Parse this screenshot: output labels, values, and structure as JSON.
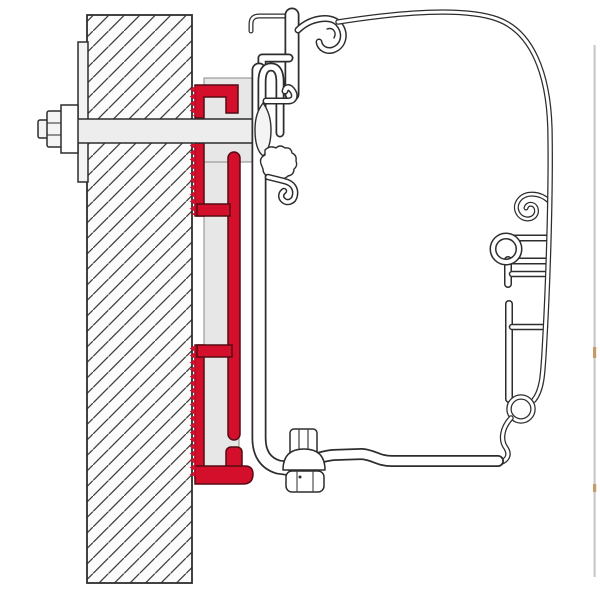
{
  "figure": {
    "kind": "technical-cross-section-line-drawing",
    "parts": {
      "wall": "hatched wall cross-section",
      "mounting_plate": "backing plate on wall face",
      "through_bolt": "through-bolt with hex head and washer",
      "adapter_bracket": "red adapter rail profile with serrated wall edge",
      "rail_profile": "white awning lead rail extrusion",
      "fixing_screw": "screw with dome washer and hex head",
      "case_outline": "awning case outer profile sweep"
    }
  },
  "colors": {
    "background": "#ffffff",
    "wall_fill": "#fcfcfc",
    "hatch": "#3e3e3e",
    "outline": "#2d2d2d",
    "metal": "#ededed",
    "metal_light": "#f4f4f4",
    "shading": "#e7e7e7",
    "shading_edge": "#8a8a8a",
    "bracket_red": "#d30f2b",
    "bracket_outline": "#550b14",
    "border": "#c9c9c9",
    "accent_tick": "#c79a68"
  }
}
